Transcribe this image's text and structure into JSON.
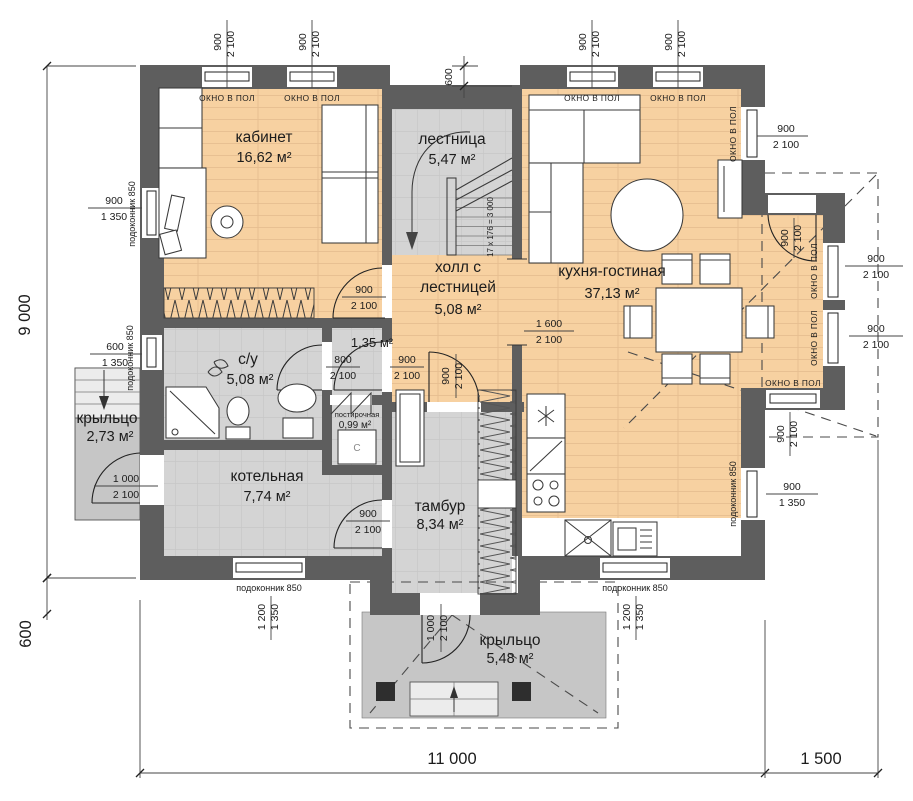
{
  "rooms": {
    "kabinet": {
      "name": "кабинет",
      "area": "16,62 м²"
    },
    "lestnitsa": {
      "name": "лестница",
      "area": "5,47 м²"
    },
    "hall": {
      "line1": "холл с",
      "line2": "лестницей",
      "area": "5,08 м²"
    },
    "kitchen": {
      "name": "кухня-гостиная",
      "area": "37,13 м²"
    },
    "su": {
      "name": "с/у",
      "area": "5,08 м²"
    },
    "closet": {
      "area": "1,35 м²"
    },
    "laundry": {
      "name": "постирочная",
      "area": "0,99 м²"
    },
    "boiler": {
      "name": "котельная",
      "area": "7,74 м²"
    },
    "tambur": {
      "name": "тамбур",
      "area": "8,34 м²"
    },
    "porch_left": {
      "name": "крыльцо",
      "area": "2,73 м²"
    },
    "porch_bottom": {
      "name": "крыльцо",
      "area": "5,48 м²"
    }
  },
  "labels": {
    "window_floor": "ОКНО В ПОЛ",
    "sill": "подоконник 850",
    "stairs_formula": "17 x 176 = 3 000",
    "washer": "С"
  },
  "dims": {
    "d900": "900",
    "d2100": "2 100",
    "d1350": "1 350",
    "d600": "600",
    "d800": "800",
    "d1000": "1 000",
    "d1200": "1 200",
    "d1600": "1 600",
    "d9000": "9 000",
    "d11000": "11 000",
    "d1500": "1 500"
  },
  "colors": {
    "wall": "#5e5e5e",
    "floor_living": "#f7d1a1",
    "floor_plank_line": "#e4bb8d",
    "floor_tech": "#d4d4d4",
    "floor_porch": "#c6c6c6",
    "column": "#2e2e2e"
  }
}
